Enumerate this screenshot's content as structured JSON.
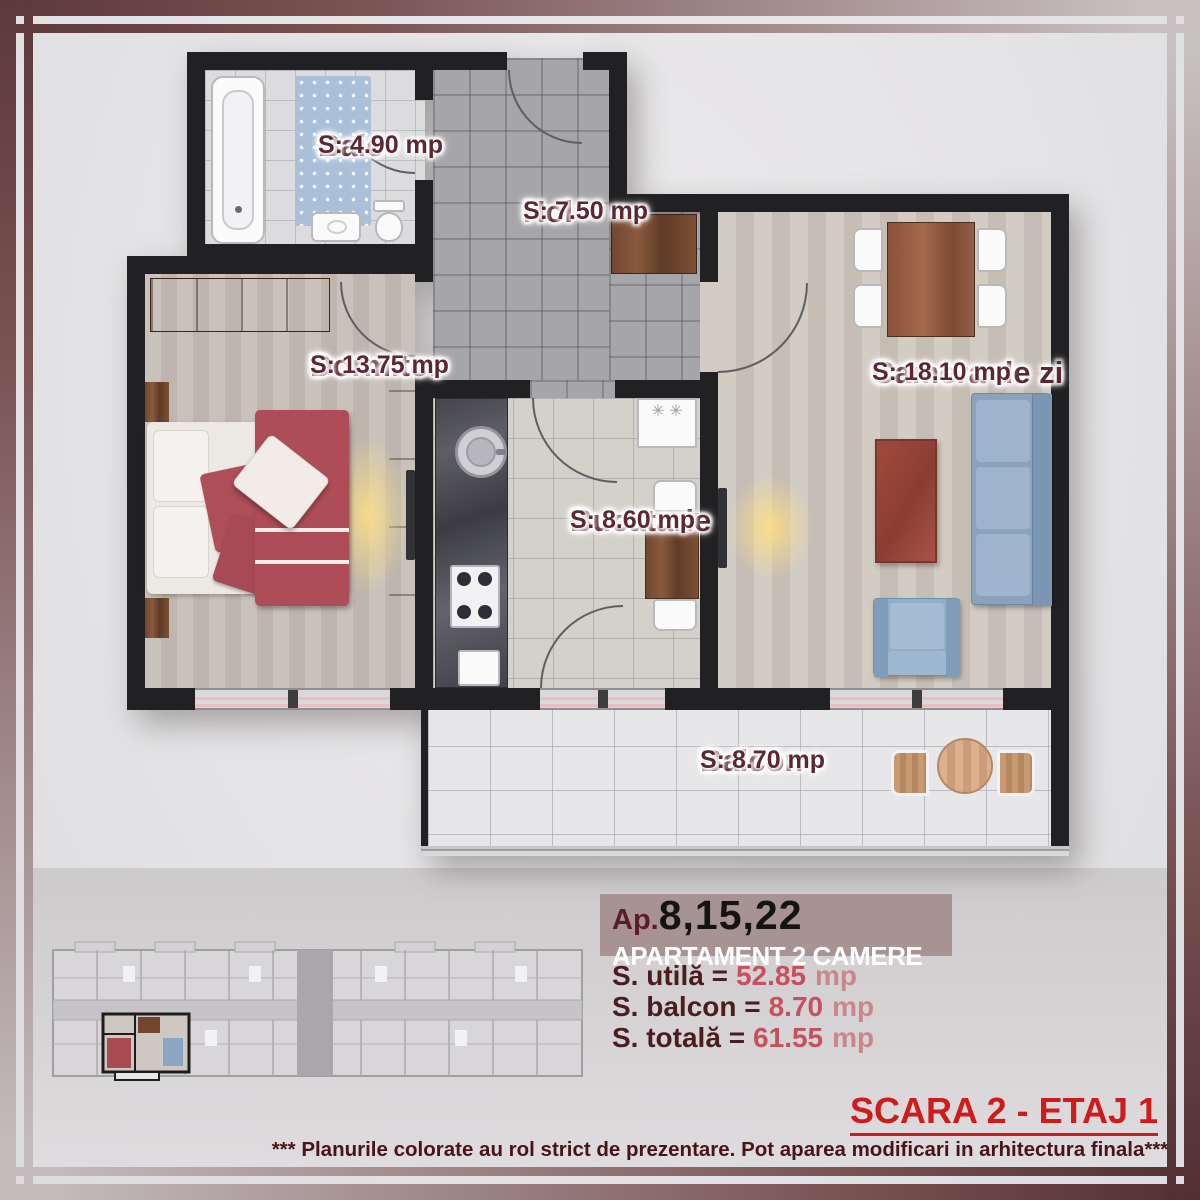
{
  "plan": {
    "rooms": [
      {
        "id": "baie",
        "name": "Baie",
        "area": "S: 4.90 mp"
      },
      {
        "id": "hol",
        "name": "Hol",
        "area": "S: 7.50 mp"
      },
      {
        "id": "dormitor",
        "name": "Dormitor",
        "area": "S: 13.75 mp"
      },
      {
        "id": "bucatarie",
        "name": "Bucatarie",
        "area": "S: 8.60 mp"
      },
      {
        "id": "camera-de-zi",
        "name": "Camera de zi",
        "area": "S: 18.10 mp"
      },
      {
        "id": "balcon",
        "name": "Balcon",
        "area": "S: 8.70 mp"
      }
    ]
  },
  "info": {
    "ap_prefix": "Ap.",
    "ap_numbers": "8,15,22",
    "subtitle": "APARTAMENT 2 CAMERE",
    "metrics": [
      {
        "label": "S. utilă =",
        "value": "52.85",
        "unit": "mp"
      },
      {
        "label": "S. balcon =",
        "value": "8.70",
        "unit": "mp"
      },
      {
        "label": "S. totală =",
        "value": "61.55",
        "unit": "mp"
      }
    ]
  },
  "footer": {
    "scara": "SCARA 2 - ETAJ 1",
    "disclaimer": "*** Planurile colorate au rol strict de prezentare. Pot aparea modificari in arhitectura finala***"
  },
  "colors": {
    "label_maroon": "#5c2733",
    "accent_red": "#ce1b1b",
    "value_red": "#c4515c",
    "band_mauve": "#a79394",
    "wall_black": "#212124"
  }
}
